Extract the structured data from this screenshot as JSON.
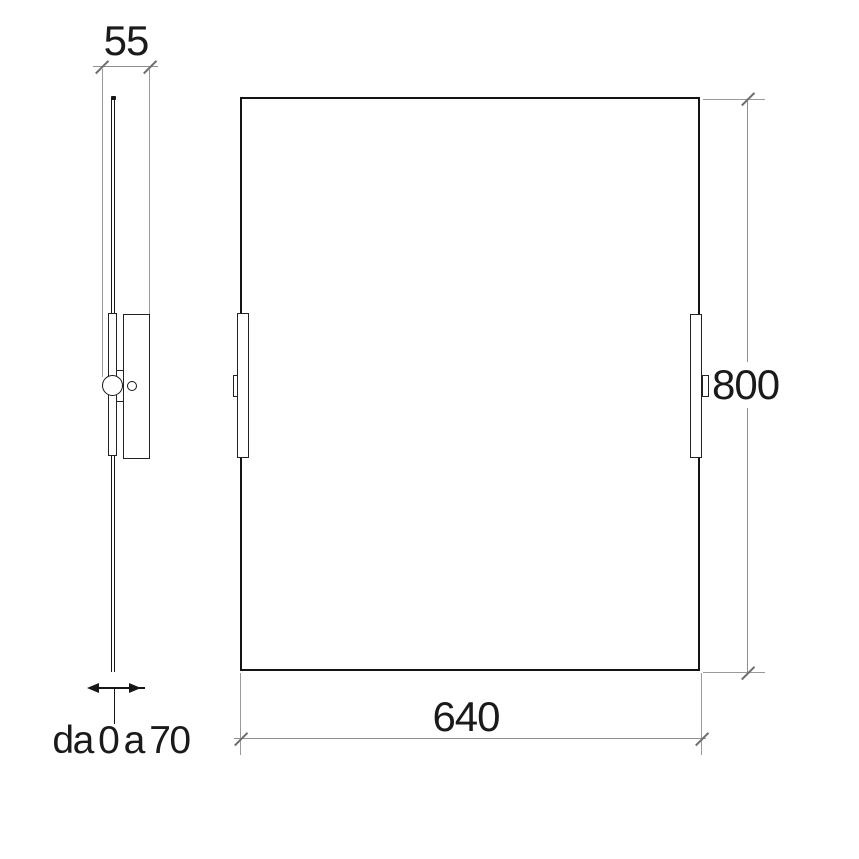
{
  "diagram": {
    "description": "technical-drawing-mirror-two-views",
    "labels": {
      "depth": "55",
      "height": "800",
      "width": "640",
      "adjustment_range": "da 0 a 70"
    },
    "colors": {
      "outline": "#161616",
      "dimension_line": "#8f8f8f",
      "background": "#ffffff"
    }
  }
}
